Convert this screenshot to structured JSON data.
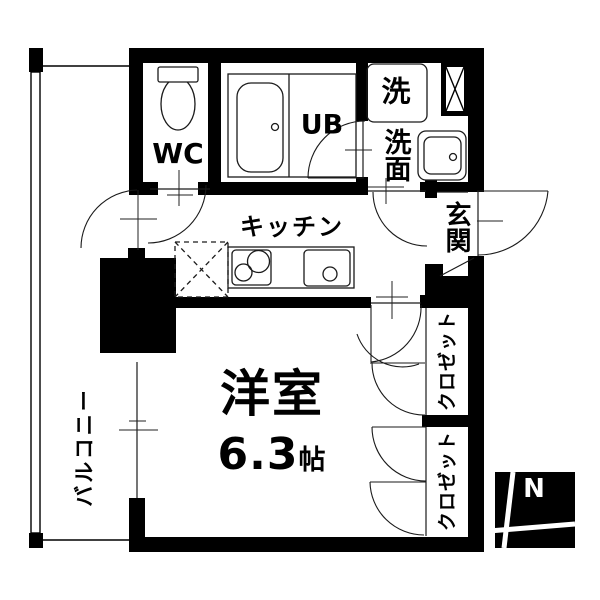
{
  "colors": {
    "wall": "#000000",
    "line": "#1a1a1a",
    "bg": "#ffffff"
  },
  "rooms": {
    "wc": {
      "label": "WC"
    },
    "unit_bath": {
      "label": "UB"
    },
    "washer": {
      "label": "洗"
    },
    "washroom": {
      "label": "洗面"
    },
    "entrance": {
      "label": "玄関"
    },
    "kitchen": {
      "label": "キッチン"
    },
    "western_room": {
      "label": "洋室",
      "size_value": "6.3",
      "size_unit": "帖"
    },
    "closet_upper": {
      "label": "クロゼット"
    },
    "closet_lower": {
      "label": "クロゼット"
    },
    "balcony": {
      "label": "バルコニー"
    }
  },
  "compass": {
    "label": "N"
  }
}
